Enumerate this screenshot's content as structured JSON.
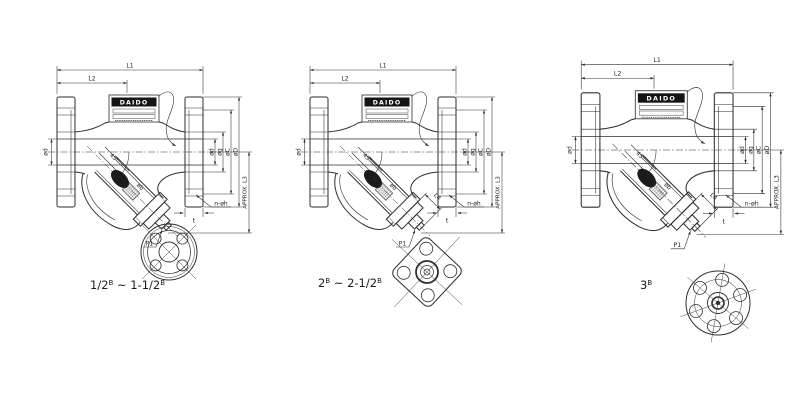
{
  "drawing": {
    "brand": "DAIDO",
    "dim_labels": {
      "l1": "L1",
      "l2": "L2",
      "l3": "APPROX. L3",
      "l4": "L4",
      "bore_dia": "ød",
      "face_dia": "øg",
      "bolt_circle_dia": "øC",
      "flange_od": "øD",
      "bolt_holes": "n-øh",
      "flange_thickness": "t",
      "drain_plug": "P1",
      "screen_angle": "45°",
      "screen_dia": "øb"
    },
    "views": [
      {
        "name": "small-sizes",
        "caption": {
          "base": "1/2",
          "sup1": "B",
          "range": " ~ 1-1/2",
          "sup2": "B"
        }
      },
      {
        "name": "medium-sizes",
        "caption": {
          "base": "2",
          "sup1": "B",
          "range": " ~ 2-1/2",
          "sup2": "B"
        }
      },
      {
        "name": "large-size",
        "caption": {
          "base": "3",
          "sup1": "B",
          "range": "",
          "sup2": ""
        }
      }
    ]
  }
}
